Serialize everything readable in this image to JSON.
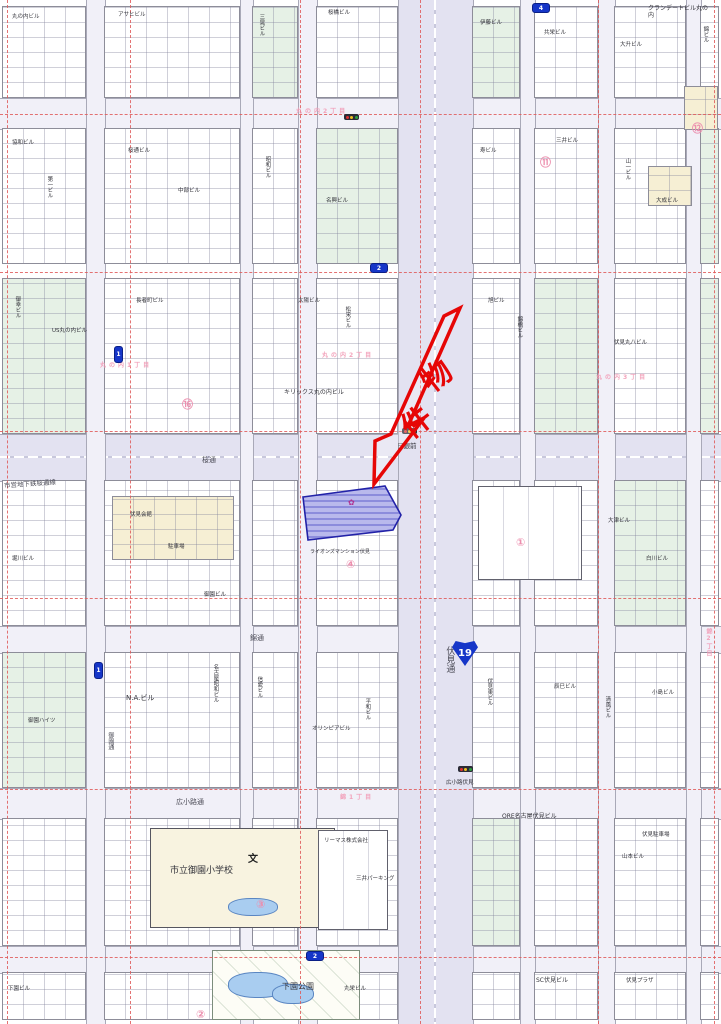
{
  "map": {
    "property": {
      "label": "物件",
      "arrow_color": "#e60606",
      "parcel_fill": "#8c8cdc",
      "parcel_border": "#2222a8",
      "parcel_points": "303,497 385,486 401,515 393,530 308,540",
      "arrow_points": "460,308 408,426 424,418 374,484 375,441 391,434 444,316",
      "char_positions": [
        {
          "x": 420,
          "y": 352
        },
        {
          "x": 400,
          "y": 398
        }
      ]
    },
    "route_shield": {
      "number": "19",
      "x": 452,
      "y": 640,
      "color": "#1636c8"
    },
    "district_labels": [
      {
        "t": "丸の内2丁目",
        "x": 296,
        "y": 106
      },
      {
        "t": "丸の内1丁目",
        "x": 100,
        "y": 360
      },
      {
        "t": "丸の内2丁目",
        "x": 322,
        "y": 350
      },
      {
        "t": "丸の内3丁目",
        "x": 596,
        "y": 372
      },
      {
        "t": "錦1丁目",
        "x": 340,
        "y": 792
      },
      {
        "t": "錦2丁目",
        "x": 704,
        "y": 628,
        "v": 1
      }
    ],
    "street_labels": [
      {
        "t": "伏見通",
        "x": 444,
        "y": 646,
        "v": 1,
        "s": 9,
        "c": "st"
      },
      {
        "t": "市営地下鉄桜通線",
        "x": 4,
        "y": 481,
        "s": 6.5,
        "r": -4,
        "c": "st"
      },
      {
        "t": "桜通",
        "x": 202,
        "y": 456,
        "s": 7,
        "c": "st"
      },
      {
        "t": "錦通",
        "x": 250,
        "y": 634,
        "s": 7,
        "c": "st"
      },
      {
        "t": "広小路通",
        "x": 176,
        "y": 798,
        "s": 7,
        "c": "st"
      },
      {
        "t": "御園通",
        "x": 106,
        "y": 732,
        "v": 1,
        "s": 6,
        "c": "st"
      }
    ],
    "poi_labels": [
      {
        "t": "キリックス丸の内ビル",
        "x": 284,
        "y": 390
      },
      {
        "t": "N.A.ビル",
        "x": 126,
        "y": 694,
        "s": 7
      },
      {
        "t": "ORE名古屋伏見ビル",
        "x": 502,
        "y": 814
      },
      {
        "t": "市立御園小学校",
        "x": 170,
        "y": 866,
        "s": 9
      },
      {
        "t": "文",
        "x": 248,
        "y": 850,
        "s": 10,
        "c": "schoolmark"
      },
      {
        "t": "下園公園",
        "x": 282,
        "y": 982,
        "s": 8
      },
      {
        "t": "SC伏見ビル",
        "x": 536,
        "y": 978
      },
      {
        "t": "クランデートビル丸の内",
        "x": 648,
        "y": 6,
        "wrap": 60
      },
      {
        "t": "日銀前",
        "x": 397,
        "y": 443,
        "s": 6.5
      },
      {
        "t": "広小路伏見",
        "x": 446,
        "y": 780,
        "s": 5.5
      },
      {
        "t": "伏見丸八ビル",
        "x": 614,
        "y": 340,
        "s": 5.5
      },
      {
        "t": "リーマス株式会社",
        "x": 324,
        "y": 838,
        "s": 5.5
      },
      {
        "t": "三井パーキング",
        "x": 356,
        "y": 876,
        "s": 5.5
      },
      {
        "t": "山本ビル",
        "x": 622,
        "y": 854,
        "s": 5.5
      },
      {
        "t": "御園ハイツ",
        "x": 28,
        "y": 718,
        "s": 5.5
      },
      {
        "t": "名古屋昭和ビル",
        "x": 212,
        "y": 664,
        "v": 1,
        "s": 5.5
      },
      {
        "t": "オリンピアビル",
        "x": 312,
        "y": 726,
        "s": 5.5
      },
      {
        "t": "伏見会館",
        "x": 130,
        "y": 512,
        "s": 5.5
      },
      {
        "t": "駐車場",
        "x": 168,
        "y": 544,
        "s": 5.5
      },
      {
        "t": "ライオンズマンション伏見",
        "x": 310,
        "y": 550,
        "s": 5
      },
      {
        "t": "御園ビル",
        "x": 204,
        "y": 592,
        "s": 5.5
      },
      {
        "t": "大津ビル",
        "x": 608,
        "y": 518,
        "s": 5.5
      },
      {
        "t": "白川ビル",
        "x": 646,
        "y": 556,
        "s": 5.5
      },
      {
        "t": "堀川ビル",
        "x": 12,
        "y": 556,
        "s": 5.5
      },
      {
        "t": "丸の内ビル",
        "x": 12,
        "y": 14,
        "s": 5.5
      },
      {
        "t": "アサヒビル",
        "x": 118,
        "y": 12,
        "s": 5.5
      },
      {
        "t": "三晃ビル",
        "x": 258,
        "y": 14,
        "v": 1,
        "s": 5.5
      },
      {
        "t": "桜橋ビル",
        "x": 328,
        "y": 10,
        "s": 5.5
      },
      {
        "t": "伊藤ビル",
        "x": 480,
        "y": 20,
        "s": 5.5
      },
      {
        "t": "共栄ビル",
        "x": 544,
        "y": 30,
        "s": 5.5
      },
      {
        "t": "大升ビル",
        "x": 620,
        "y": 42,
        "s": 5.5
      },
      {
        "t": "錦ビル",
        "x": 702,
        "y": 26,
        "v": 1,
        "s": 5.5
      },
      {
        "t": "協和ビル",
        "x": 12,
        "y": 140,
        "s": 5.5
      },
      {
        "t": "第一ビル",
        "x": 46,
        "y": 176,
        "v": 1,
        "s": 5.5
      },
      {
        "t": "桜通ビル",
        "x": 128,
        "y": 148,
        "s": 5.5
      },
      {
        "t": "中部ビル",
        "x": 178,
        "y": 188,
        "s": 5.5
      },
      {
        "t": "昭和ビル",
        "x": 264,
        "y": 156,
        "v": 1,
        "s": 5.5
      },
      {
        "t": "名興ビル",
        "x": 326,
        "y": 198,
        "s": 5.5
      },
      {
        "t": "寿ビル",
        "x": 480,
        "y": 148,
        "s": 5.5
      },
      {
        "t": "三井ビル",
        "x": 556,
        "y": 138,
        "s": 5.5
      },
      {
        "t": "山一ビル",
        "x": 624,
        "y": 158,
        "v": 1,
        "s": 5.5
      },
      {
        "t": "大成ビル",
        "x": 656,
        "y": 198,
        "s": 5.5
      },
      {
        "t": "御幸ビル",
        "x": 14,
        "y": 296,
        "v": 1,
        "s": 5.5
      },
      {
        "t": "US丸の内ビル",
        "x": 52,
        "y": 328,
        "s": 5.5
      },
      {
        "t": "長者町ビル",
        "x": 136,
        "y": 298,
        "s": 5.5
      },
      {
        "t": "太陽ビル",
        "x": 298,
        "y": 298,
        "s": 5.5
      },
      {
        "t": "松栄ビル",
        "x": 344,
        "y": 306,
        "v": 1,
        "s": 5.5
      },
      {
        "t": "旭ビル",
        "x": 488,
        "y": 298,
        "s": 5.5
      },
      {
        "t": "錦橋ビル",
        "x": 516,
        "y": 316,
        "v": 1,
        "s": 5.5
      },
      {
        "t": "信愛ビル",
        "x": 256,
        "y": 676,
        "v": 1,
        "s": 5.5
      },
      {
        "t": "平和ビル",
        "x": 364,
        "y": 698,
        "v": 1,
        "s": 5.5
      },
      {
        "t": "伏見東ビル",
        "x": 486,
        "y": 678,
        "v": 1,
        "s": 5.5
      },
      {
        "t": "辰巳ビル",
        "x": 554,
        "y": 684,
        "s": 5.5
      },
      {
        "t": "清風ビル",
        "x": 604,
        "y": 696,
        "v": 1,
        "s": 5.5
      },
      {
        "t": "小島ビル",
        "x": 652,
        "y": 690,
        "s": 5.5
      },
      {
        "t": "伏見駐車場",
        "x": 642,
        "y": 832,
        "s": 5.5
      },
      {
        "t": "下園ビル",
        "x": 8,
        "y": 986,
        "s": 5.5
      },
      {
        "t": "伏見プラザ",
        "x": 626,
        "y": 978,
        "s": 5.5
      },
      {
        "t": "丸栄ビル",
        "x": 344,
        "y": 986,
        "s": 5.5
      }
    ],
    "circled_numbers": [
      {
        "t": "⑯",
        "x": 182,
        "y": 396
      },
      {
        "t": "④",
        "x": 346,
        "y": 558
      },
      {
        "t": "①",
        "x": 516,
        "y": 536
      },
      {
        "t": "③",
        "x": 256,
        "y": 898
      },
      {
        "t": "⑪",
        "x": 540,
        "y": 154
      },
      {
        "t": "②",
        "x": 196,
        "y": 1008
      },
      {
        "t": "⑫",
        "x": 692,
        "y": 120
      }
    ],
    "exit_pills": [
      {
        "x": 114,
        "y": 346,
        "n": "1",
        "v": 1
      },
      {
        "x": 94,
        "y": 662,
        "n": "1",
        "v": 1
      },
      {
        "x": 532,
        "y": 3,
        "n": "4"
      },
      {
        "x": 370,
        "y": 263,
        "n": "2"
      },
      {
        "x": 306,
        "y": 951,
        "n": "2"
      }
    ],
    "signals": [
      {
        "x": 402,
        "y": 428
      },
      {
        "x": 458,
        "y": 766
      },
      {
        "x": 344,
        "y": 114
      }
    ],
    "signal_colors": [
      "#e03030",
      "#f0c020",
      "#30a040"
    ],
    "roads_h": [
      {
        "y": 98,
        "h": 30,
        "major": 0
      },
      {
        "y": 434,
        "h": 46,
        "major": 1
      },
      {
        "y": 626,
        "h": 26,
        "major": 0
      },
      {
        "y": 788,
        "h": 30,
        "major": 0
      },
      {
        "y": 946,
        "h": 26,
        "major": 0
      }
    ],
    "roads_v": [
      {
        "x": 86,
        "w": 18,
        "major": 0
      },
      {
        "x": 240,
        "w": 12,
        "major": 0
      },
      {
        "x": 298,
        "w": 18,
        "major": 0
      },
      {
        "x": 398,
        "w": 74,
        "major": 1
      },
      {
        "x": 520,
        "w": 14,
        "major": 0
      },
      {
        "x": 598,
        "w": 16,
        "major": 0
      },
      {
        "x": 686,
        "w": 14,
        "major": 0
      }
    ],
    "gridlines": {
      "v": [
        7,
        130,
        300,
        420,
        598,
        714
      ],
      "h": [
        114,
        272,
        431,
        598,
        789,
        957
      ],
      "color": "#e05a5a"
    },
    "blocks": [
      [
        2,
        6,
        84,
        92,
        "w"
      ],
      [
        104,
        6,
        136,
        92,
        "w"
      ],
      [
        252,
        6,
        46,
        92,
        "g"
      ],
      [
        316,
        6,
        82,
        92,
        "w"
      ],
      [
        472,
        6,
        48,
        92,
        "g"
      ],
      [
        534,
        6,
        64,
        92,
        "w"
      ],
      [
        614,
        6,
        72,
        92,
        "w"
      ],
      [
        700,
        6,
        19,
        92,
        "w"
      ],
      [
        2,
        128,
        84,
        136,
        "w"
      ],
      [
        104,
        128,
        136,
        136,
        "w"
      ],
      [
        252,
        128,
        46,
        136,
        "w"
      ],
      [
        316,
        128,
        82,
        136,
        "g"
      ],
      [
        472,
        128,
        48,
        136,
        "w"
      ],
      [
        534,
        128,
        64,
        136,
        "w"
      ],
      [
        614,
        128,
        72,
        136,
        "w"
      ],
      [
        700,
        128,
        19,
        136,
        "g"
      ],
      [
        2,
        278,
        84,
        156,
        "g"
      ],
      [
        104,
        278,
        136,
        156,
        "w"
      ],
      [
        252,
        278,
        46,
        156,
        "w"
      ],
      [
        316,
        278,
        82,
        156,
        "w"
      ],
      [
        472,
        278,
        48,
        156,
        "w"
      ],
      [
        534,
        278,
        64,
        156,
        "g"
      ],
      [
        614,
        278,
        72,
        156,
        "w"
      ],
      [
        700,
        278,
        19,
        156,
        "g"
      ],
      [
        2,
        480,
        84,
        146,
        "w"
      ],
      [
        104,
        480,
        136,
        146,
        "w"
      ],
      [
        252,
        480,
        46,
        146,
        "w"
      ],
      [
        316,
        480,
        82,
        146,
        "w"
      ],
      [
        472,
        480,
        48,
        146,
        "w"
      ],
      [
        534,
        480,
        64,
        146,
        "w"
      ],
      [
        614,
        480,
        72,
        146,
        "g"
      ],
      [
        700,
        480,
        19,
        146,
        "w"
      ],
      [
        2,
        652,
        84,
        136,
        "g"
      ],
      [
        104,
        652,
        136,
        136,
        "w"
      ],
      [
        252,
        652,
        46,
        136,
        "w"
      ],
      [
        316,
        652,
        82,
        136,
        "w"
      ],
      [
        472,
        652,
        48,
        136,
        "w"
      ],
      [
        534,
        652,
        64,
        136,
        "w"
      ],
      [
        614,
        652,
        72,
        136,
        "w"
      ],
      [
        700,
        652,
        19,
        136,
        "w"
      ],
      [
        2,
        818,
        84,
        128,
        "w"
      ],
      [
        104,
        818,
        136,
        128,
        "w"
      ],
      [
        252,
        818,
        46,
        128,
        "w"
      ],
      [
        316,
        818,
        82,
        128,
        "w"
      ],
      [
        472,
        818,
        48,
        128,
        "g"
      ],
      [
        534,
        818,
        64,
        128,
        "w"
      ],
      [
        614,
        818,
        72,
        128,
        "w"
      ],
      [
        700,
        818,
        19,
        128,
        "w"
      ],
      [
        2,
        972,
        84,
        48,
        "w"
      ],
      [
        104,
        972,
        136,
        48,
        "w"
      ],
      [
        252,
        972,
        46,
        48,
        "w"
      ],
      [
        316,
        972,
        82,
        48,
        "w"
      ],
      [
        472,
        972,
        48,
        48,
        "w"
      ],
      [
        534,
        972,
        64,
        48,
        "w"
      ],
      [
        614,
        972,
        72,
        48,
        "w"
      ],
      [
        700,
        972,
        19,
        48,
        "w"
      ],
      [
        112,
        496,
        122,
        64,
        "c"
      ],
      [
        684,
        86,
        34,
        44,
        "c"
      ],
      [
        648,
        166,
        44,
        40,
        "c"
      ],
      [
        150,
        828,
        185,
        100,
        "c2"
      ],
      [
        478,
        486,
        104,
        94,
        "b"
      ],
      [
        318,
        830,
        70,
        100,
        "b"
      ],
      [
        212,
        950,
        148,
        70,
        "p0"
      ]
    ],
    "water": [
      [
        228,
        972,
        58,
        24
      ],
      [
        272,
        984,
        40,
        18
      ],
      [
        228,
        898,
        48,
        16
      ]
    ]
  }
}
